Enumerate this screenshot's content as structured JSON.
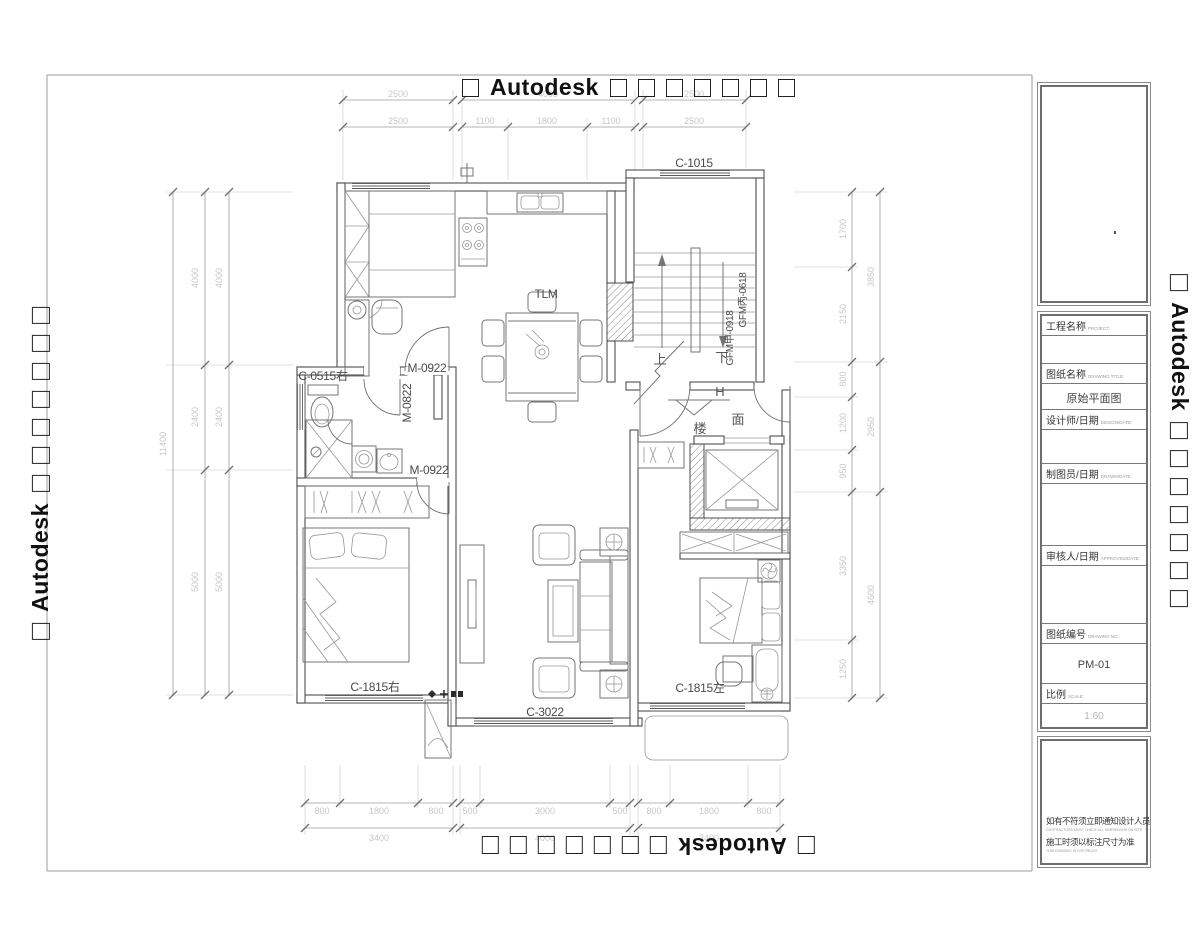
{
  "watermark": {
    "brand": "Autodesk"
  },
  "title_block": {
    "project_label": "工程名称",
    "project_sub": "PROJECT:",
    "drawing_title_label": "图纸名称",
    "drawing_title_sub": "DRAWING TITLE:",
    "drawing_title_value": "原始平面图",
    "designer_label": "设计师/日期",
    "designer_sub": "DESIGN/DATE:",
    "drafter_label": "制图员/日期",
    "drafter_sub": "DRAWN/DATE:",
    "approver_label": "审核人/日期",
    "approver_sub": "APPROVED/DATE:",
    "drawing_no_label": "图纸编号",
    "drawing_no_sub": "DRAWING NO.:",
    "drawing_no_value": "PM-01",
    "scale_label": "比例",
    "scale_sub": "SCALE:",
    "scale_value": "1:60",
    "notes": {
      "cn1": "如有不符须立即通知设计人员",
      "en1": "CONTRACTORS MUST CHECK ALL DIMENSIONS ON SITE",
      "cn2": "施工时须以标注尺寸为准",
      "en2": "THIS DRAWING IS COPYRIGHT"
    }
  },
  "plan": {
    "rooms": {
      "dining": "TLM"
    },
    "stairs": {
      "up": "上",
      "down": "下"
    },
    "entry_marker": {
      "h": "H",
      "floor1": "楼",
      "floor2": "面"
    },
    "doors": {
      "study": "M-0922",
      "bedroom": "M-0922",
      "bath": "M-0822",
      "fire1": "GFM甲-0918",
      "fire2": "GFM丙-0618"
    },
    "windows": {
      "stair": "C-1015",
      "bath": "C-0515右",
      "master": "C-1815右",
      "living": "C-3022",
      "second": "C-1815左"
    }
  },
  "dims": {
    "top1": [
      "2500",
      "4000",
      "2500"
    ],
    "top2": [
      "2500",
      "1100",
      "1800",
      "1100",
      "2500"
    ],
    "bottom1": [
      "800",
      "1800",
      "800",
      "500",
      "3000",
      "500",
      "800",
      "1800",
      "800"
    ],
    "bottom2": [
      "3400",
      "4000",
      "3400"
    ],
    "left_total": "11400",
    "left_mid": [
      "4000",
      "2400",
      "5000"
    ],
    "left_inner": [
      "4000",
      "2400",
      "5000"
    ],
    "right_inner": [
      "1700",
      "2150",
      "800",
      "1200",
      "950",
      "3350",
      "1250"
    ],
    "right_outer": [
      "3850",
      "2950",
      "4600"
    ]
  }
}
